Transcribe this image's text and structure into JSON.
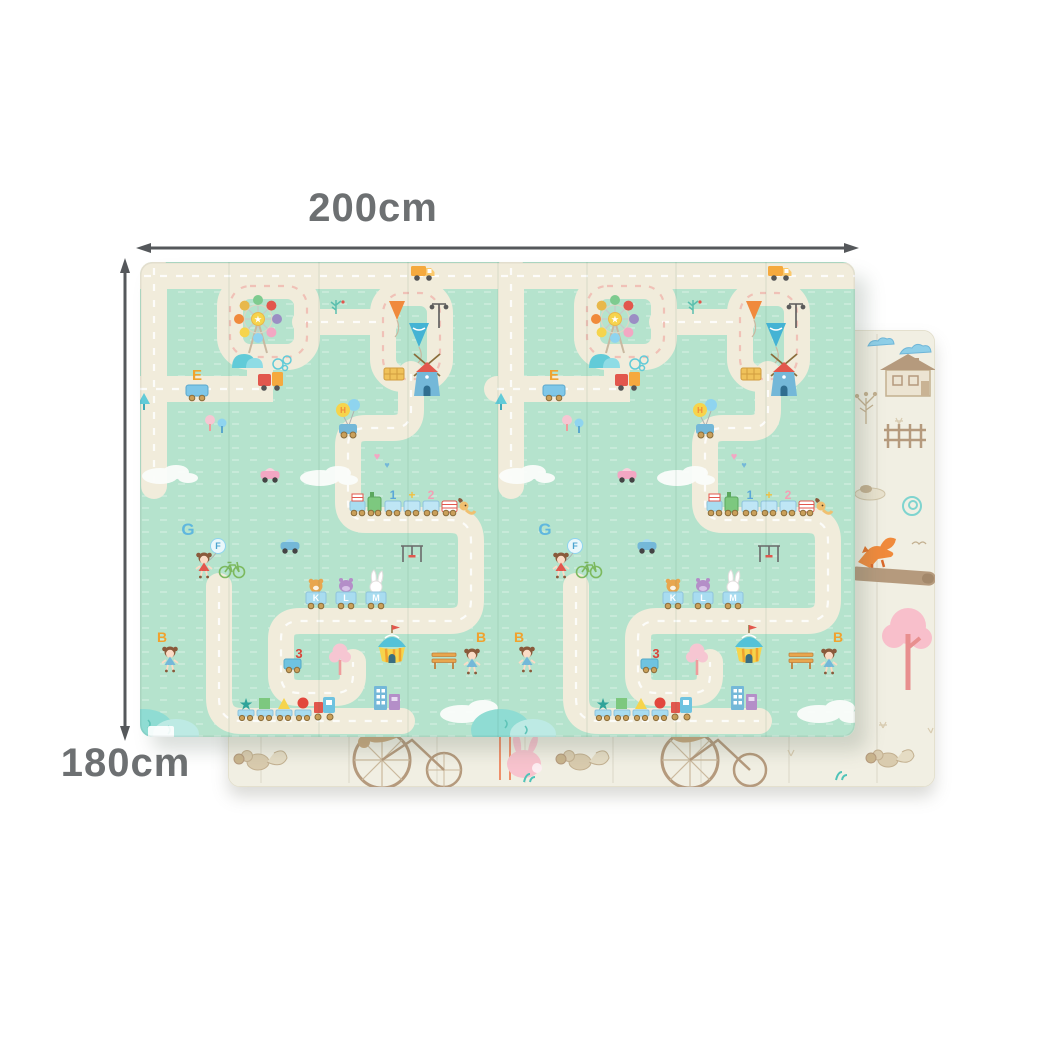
{
  "image_title": "Foldable baby play mat, front road-map side over reverse forest side",
  "dimension_labels": {
    "width": "200cm",
    "height": "180cm"
  },
  "styles": {
    "label_color": "#6d7072",
    "arrow_color": "#55585b",
    "front_mat_background": "#b5e3cd",
    "road_color": "#f1ecdb",
    "back_mat_background": "#f1efe3"
  },
  "front_mat": {
    "letters": {
      "e": "E",
      "g": "G",
      "f": "F",
      "b": "B",
      "k": "K",
      "l": "L",
      "m": "M",
      "h": "H"
    },
    "numbers": {
      "one": "1",
      "plus": "+",
      "two": "2",
      "three": "3"
    },
    "elements": [
      "ferris-wheel",
      "kites",
      "street-lamp",
      "delivery-truck",
      "windmill-house",
      "hay-bale",
      "letter-cart",
      "balloon-car",
      "number-train",
      "alphabet-animal-train",
      "girl-with-balloon",
      "bicycle",
      "circus-tent",
      "park-bench",
      "number-cart",
      "shape-train",
      "buildings",
      "pink-tree",
      "bushes",
      "clouds",
      "road-loops"
    ]
  },
  "back_mat": {
    "elements": [
      "blue-clouds",
      "country-house",
      "sketch-tree",
      "fence",
      "pond",
      "teal-swirl",
      "fox-on-log",
      "pink-tree",
      "squirrel-with-acorn",
      "penny-farthing-bicycle",
      "pink-bunny",
      "teal-sprouts",
      "sparkles"
    ]
  },
  "glyphs": {
    "star": "★",
    "heart": "♥"
  }
}
